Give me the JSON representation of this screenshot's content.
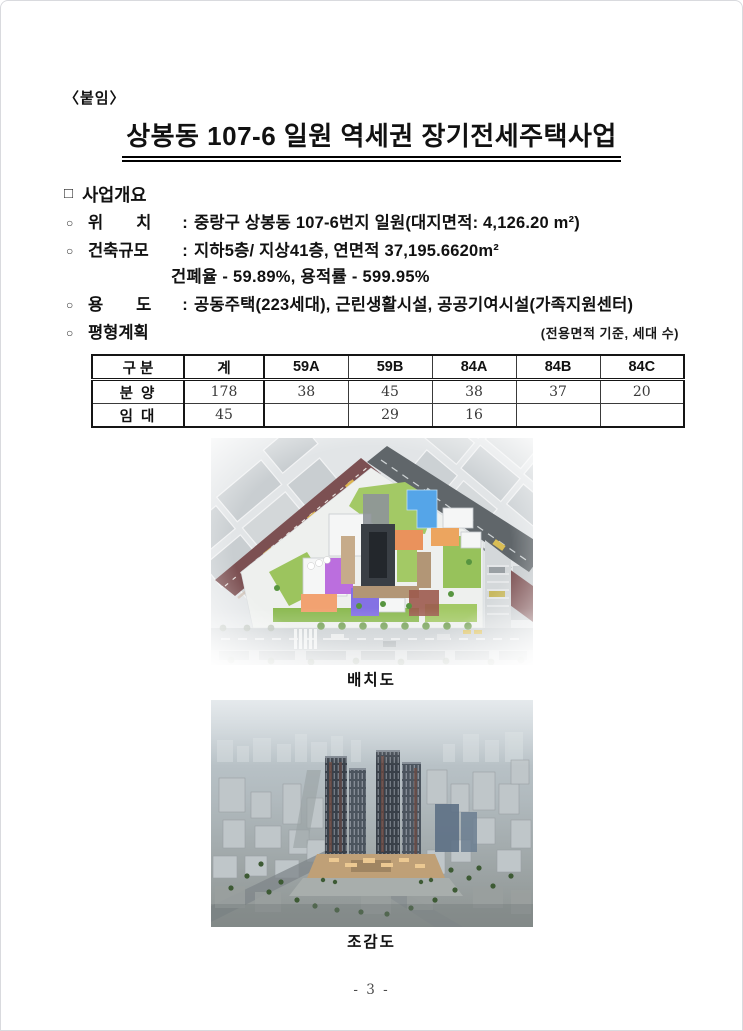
{
  "colors": {
    "text": "#111111",
    "road_red": "#7c5052",
    "road_gray": "#60666a",
    "pool_blue": "#55a5e8",
    "roof_orange": "#ea925c",
    "bldg_purple": "#bb6ede",
    "bldg_violet": "#8471e4",
    "green": "#9cc45e"
  },
  "page": {
    "attachment_label": "〈붙임〉",
    "title": "상봉동 107-6 일원 역세권 장기전세주택사업",
    "page_number": "- 3 -"
  },
  "overview": {
    "square_marker": "□",
    "circle_marker": "○",
    "section_title": "사업개요",
    "colon": ":",
    "lines": [
      {
        "label": "위　　치",
        "value": "중랑구 상봉동 107-6번지 일원(대지면적: 4,126.20 m²)"
      },
      {
        "label": "건축규모",
        "value": "지하5층/ 지상41층, 연면적 37,195.6620m²"
      },
      {
        "continuation": "건폐율 - 59.89%, 용적률 - 599.95%"
      },
      {
        "label": "용　　도",
        "value": "공동주택(223세대), 근린생활시설, 공공기여시설(가족지원센터)"
      },
      {
        "label": "평형계획",
        "note": "(전용면적 기준, 세대 수)"
      }
    ]
  },
  "table": {
    "headers": [
      "구 분",
      "계",
      "59A",
      "59B",
      "84A",
      "84B",
      "84C"
    ],
    "rows": [
      {
        "label": "분 양",
        "values": [
          "178",
          "38",
          "45",
          "38",
          "37",
          "20"
        ]
      },
      {
        "label": "임 대",
        "values": [
          "45",
          "",
          "29",
          "16",
          "",
          ""
        ]
      }
    ]
  },
  "figures": [
    {
      "caption": "배치도"
    },
    {
      "caption": "조감도"
    }
  ]
}
